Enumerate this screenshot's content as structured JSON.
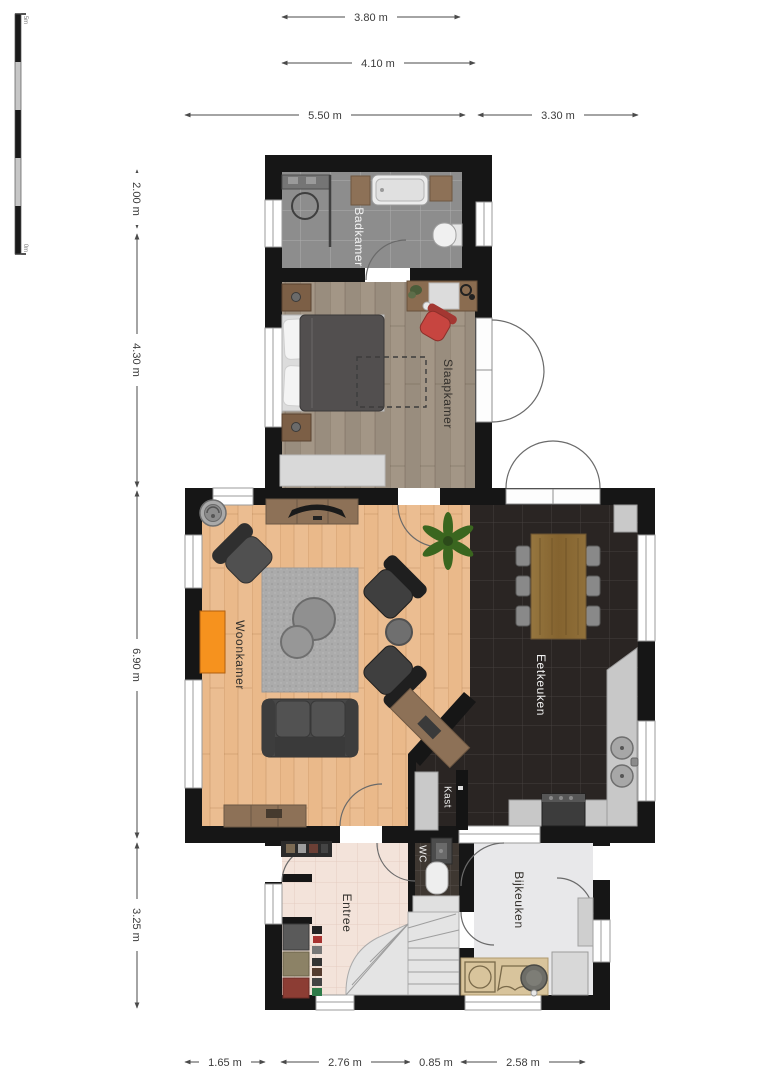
{
  "scale_bar": {
    "top_label": "5m",
    "bottom_label": "0m"
  },
  "dimensions": {
    "top": [
      {
        "label": "3.80 m"
      },
      {
        "label": "4.10 m"
      },
      {
        "label": "5.50 m"
      },
      {
        "label": "3.30 m"
      }
    ],
    "left": [
      {
        "label": "2.00 m"
      },
      {
        "label": "4.30 m"
      },
      {
        "label": "6.90 m"
      },
      {
        "label": "3.25 m"
      }
    ],
    "bottom": [
      {
        "label": "1.65 m"
      },
      {
        "label": "2.76 m"
      },
      {
        "label": "0.85 m"
      },
      {
        "label": "2.58 m"
      }
    ]
  },
  "rooms": {
    "badkamer": {
      "label": "Badkamer"
    },
    "slaapkamer": {
      "label": "Slaapkamer"
    },
    "woonkamer": {
      "label": "Woonkamer"
    },
    "eetkeuken": {
      "label": "Eetkeuken"
    },
    "kast": {
      "label": "Kast"
    },
    "wc": {
      "label": "WC"
    },
    "entree": {
      "label": "Entree"
    },
    "bijkeuken": {
      "label": "Bijkeuken"
    }
  },
  "colors": {
    "wall": "#161616",
    "badkamer_floor": "#8d8d8d",
    "slaapkamer_floor": "#a39686",
    "woonkamer_floor": "#eab98a",
    "eetkeuken_floor": "#2a2523",
    "entree_floor": "#f3e3da",
    "bijkeuken_floor": "#e8e8ea",
    "wc_floor": "#3e3731",
    "accent_orange": "#f6921e",
    "chair_red": "#c74540",
    "plant_green": "#3a661f",
    "furniture_wood": "#8d7157",
    "table_wood": "#8a6c45",
    "sofa_gray": "#474747",
    "rug_gray": "#ababab",
    "counter_gray": "#c8c8c8",
    "washer_counter_tan": "#d8c49c"
  }
}
